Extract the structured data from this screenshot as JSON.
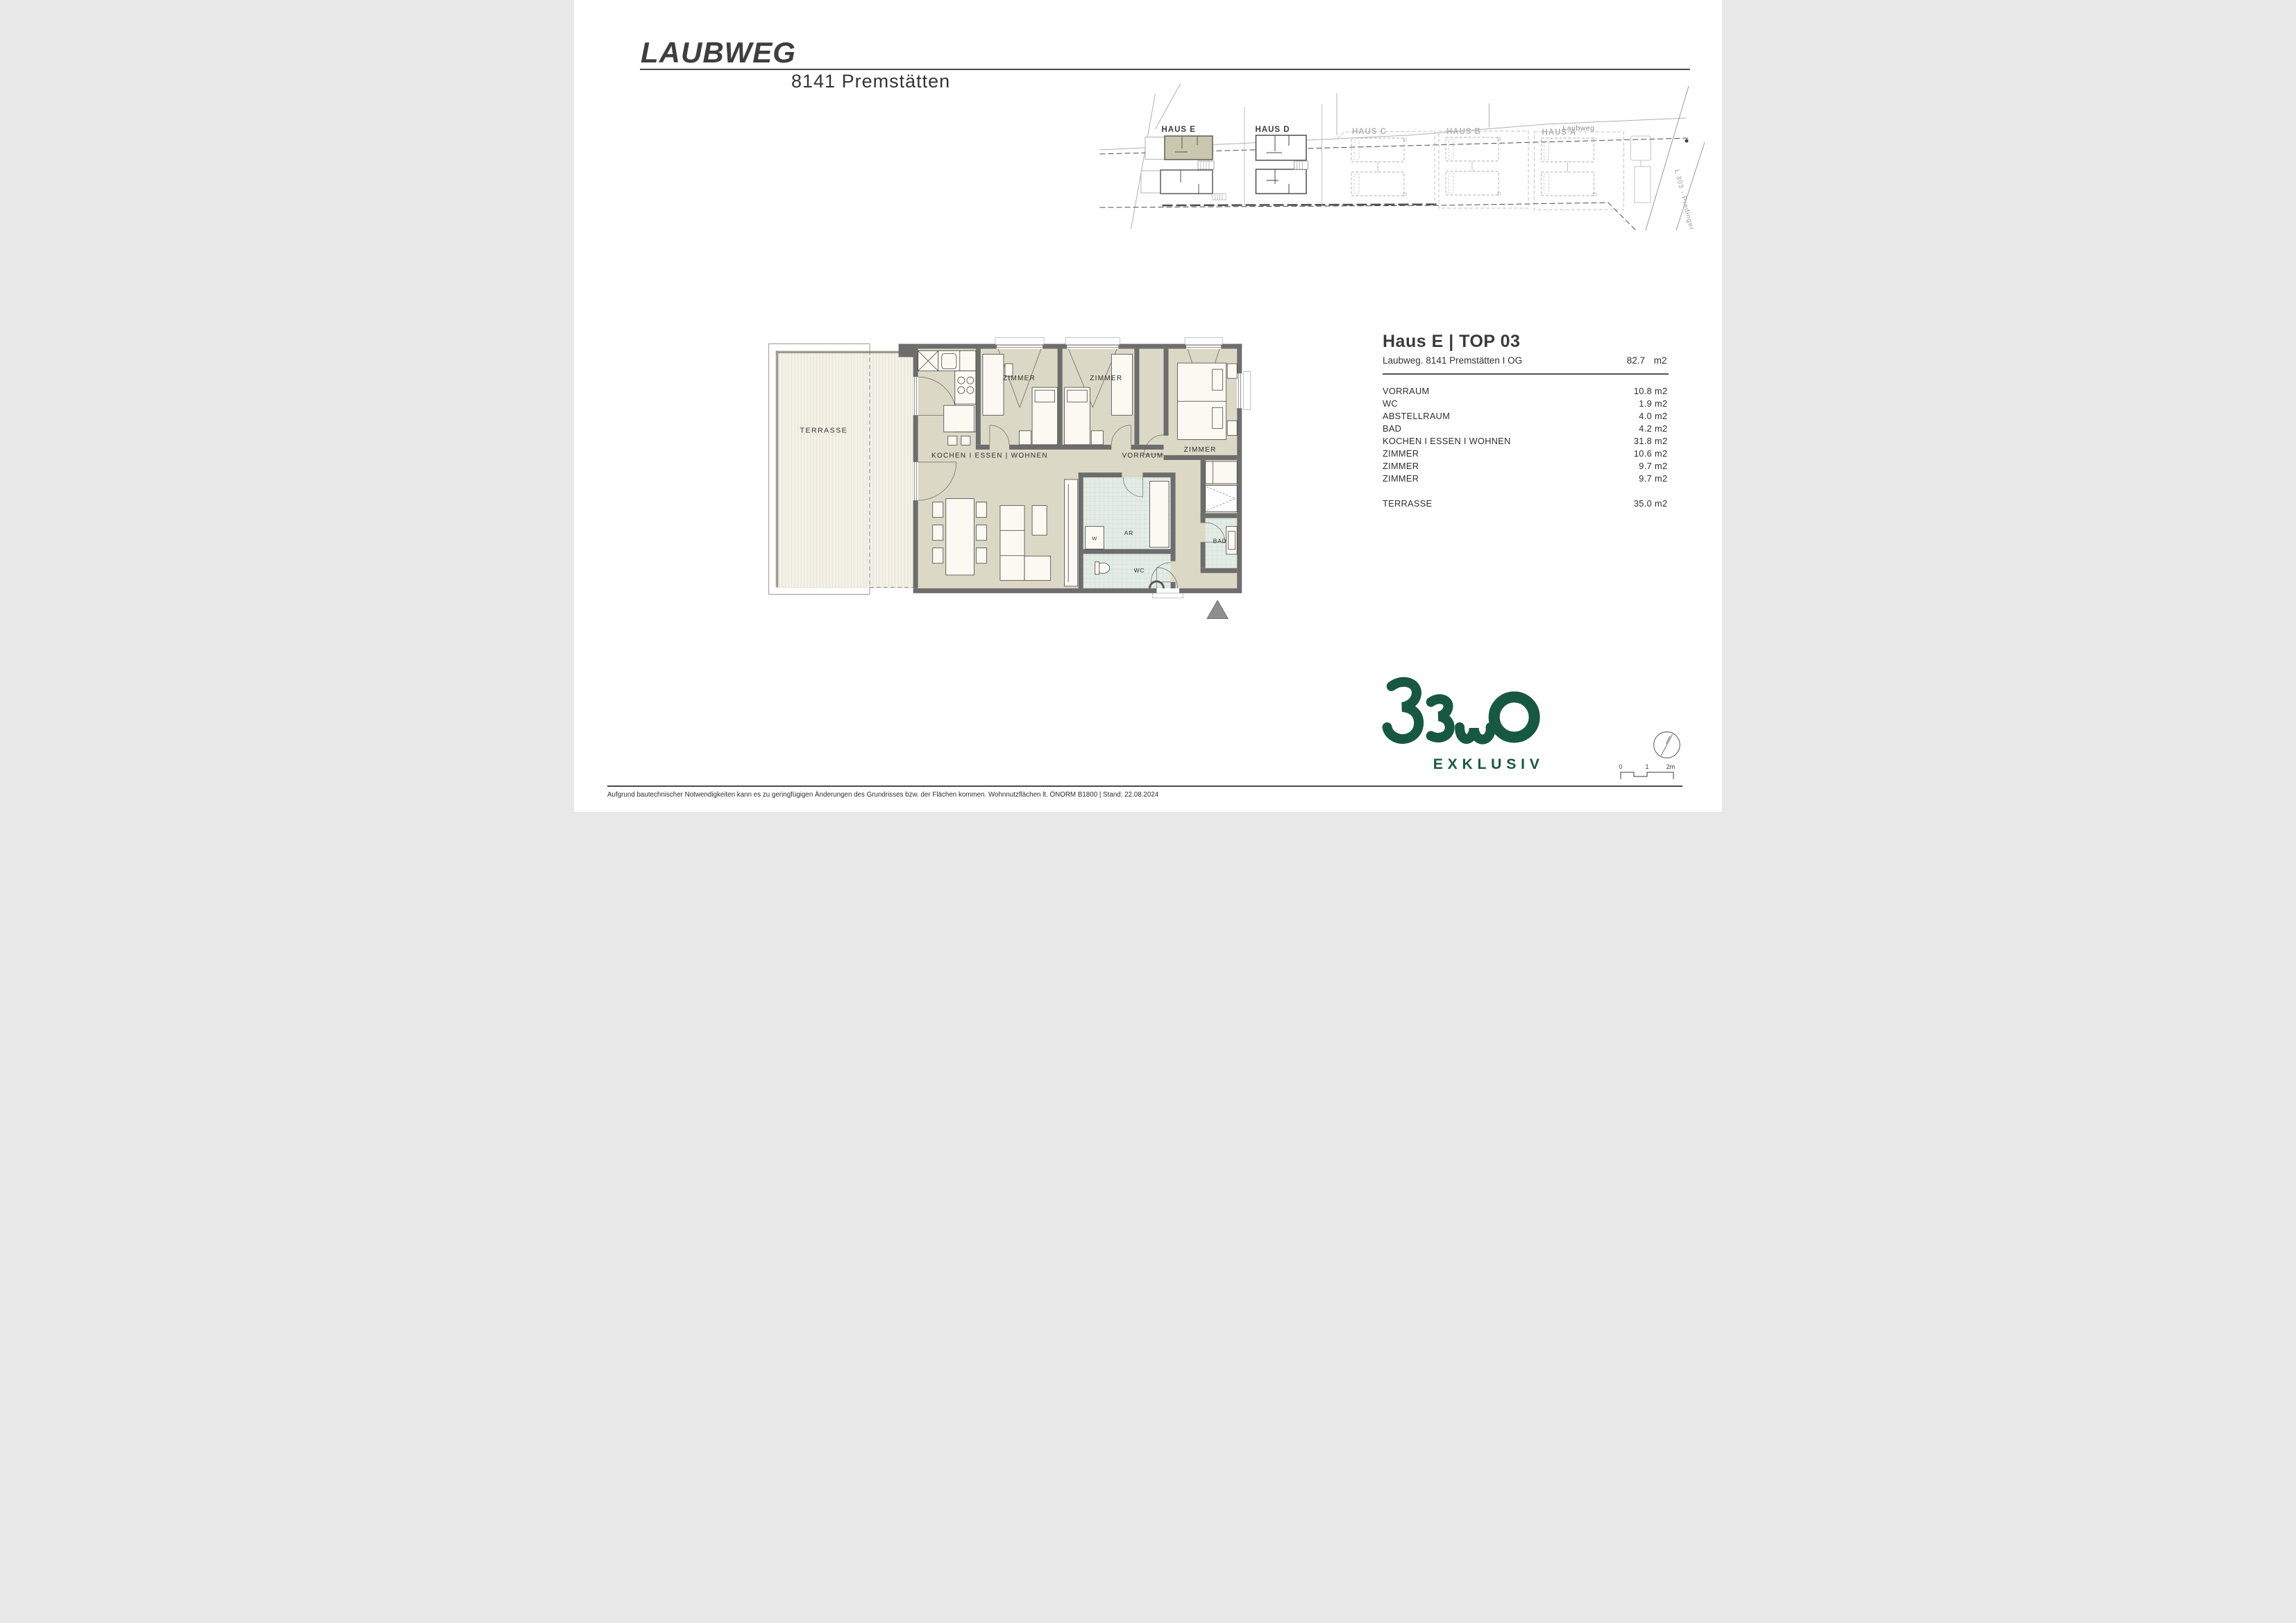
{
  "header": {
    "title": "LAUBWEG",
    "subtitle": "8141 Premstätten"
  },
  "site_plan": {
    "street_label": "Laubweg",
    "road_label": "L 303 - Predingerstraße",
    "houses": [
      {
        "label": "HAUS E",
        "highlighted": true
      },
      {
        "label": "HAUS D",
        "highlighted": false
      },
      {
        "label": "HAUS C",
        "highlighted": false
      },
      {
        "label": "HAUS B",
        "highlighted": false
      },
      {
        "label": "HAUS A",
        "highlighted": false
      }
    ],
    "highlight_color": "#cac7af"
  },
  "floor_plan": {
    "labels": {
      "terrasse": "TERRASSE",
      "kochen": "KOCHEN I ESSEN | WOHNEN",
      "vorraum": "VORRAUM",
      "zimmer": "ZIMMER",
      "ar": "AR",
      "wc": "WC",
      "bad": "BAD",
      "w": "W"
    },
    "colors": {
      "floor": "#dbd8c6",
      "wall": "#6d6d6d",
      "tile": "#e3ece5",
      "furniture": "#fbf9f2"
    }
  },
  "info_panel": {
    "title": "Haus E | TOP 03",
    "subtitle": "Laubweg. 8141 Premstätten I OG",
    "total_area": "82.7",
    "unit": "m2",
    "rooms": [
      {
        "name": "VORRAUM",
        "area": "10.8",
        "unit": "m2"
      },
      {
        "name": "WC",
        "area": "1.9",
        "unit": "m2"
      },
      {
        "name": "ABSTELLRAUM",
        "area": "4.0",
        "unit": "m2"
      },
      {
        "name": "BAD",
        "area": "4.2",
        "unit": "m2"
      },
      {
        "name": "KOCHEN I ESSEN I WOHNEN",
        "area": "31.8",
        "unit": "m2"
      },
      {
        "name": "ZIMMER",
        "area": "10.6",
        "unit": "m2"
      },
      {
        "name": "ZIMMER",
        "area": "9.7",
        "unit": "m2"
      },
      {
        "name": "ZIMMER",
        "area": "9.7",
        "unit": "m2"
      }
    ],
    "terrace_row": {
      "name": "TERRASSE",
      "area": "35.0",
      "unit": "m2"
    }
  },
  "logo": {
    "brand": "BEWO",
    "tagline": "EXKLUSIV",
    "color": "#175843"
  },
  "scale_bar": {
    "labels": [
      "0",
      "1",
      "2m"
    ]
  },
  "footer": {
    "disclaimer": "Aufgrund bautechnischer Notwendigkeiten kann es zu geringfügigen Änderungen des Grundrisses bzw. der Flächen kommen. Wohnnutzflächen lt. ÖNORM B1800 | Stand: 22.08.2024"
  }
}
